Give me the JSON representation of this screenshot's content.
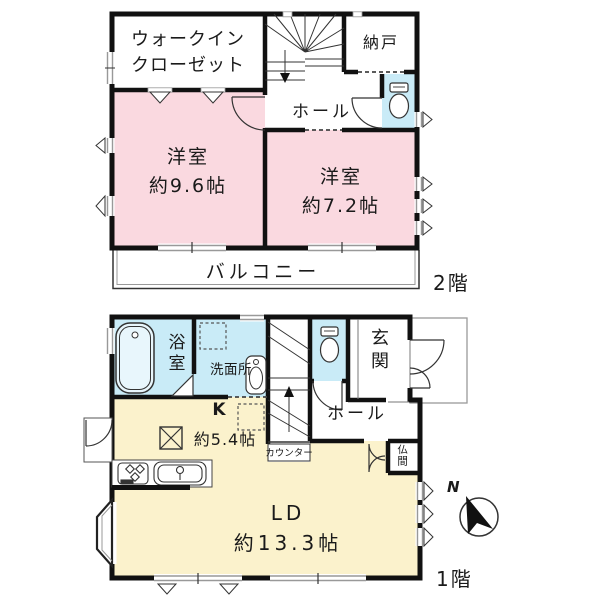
{
  "colors": {
    "room_pink": "#FAD9E0",
    "room_blue": "#C9EBF7",
    "room_yellow": "#FBF2CC",
    "wall_black": "#111111",
    "line_gray": "#999999"
  },
  "floor2": {
    "floor_label": "2階",
    "walk_in_closet": "ウォークイン\nクローゼット",
    "storage": "納戸",
    "hall": "ホール",
    "bedroom_large": "洋室\n約9.6帖",
    "bedroom_small": "洋室\n約7.2帖",
    "balcony": "バルコニー"
  },
  "floor1": {
    "floor_label": "1階",
    "bath": "浴室",
    "washroom": "洗面所",
    "entrance": "玄関",
    "hall": "ホール",
    "kitchen": "K",
    "kitchen_size": "約5.4帖",
    "counter": "カウンター",
    "altar_room": "仏間",
    "living_dining": "LD\n約13.3帖",
    "compass_north": "N"
  }
}
